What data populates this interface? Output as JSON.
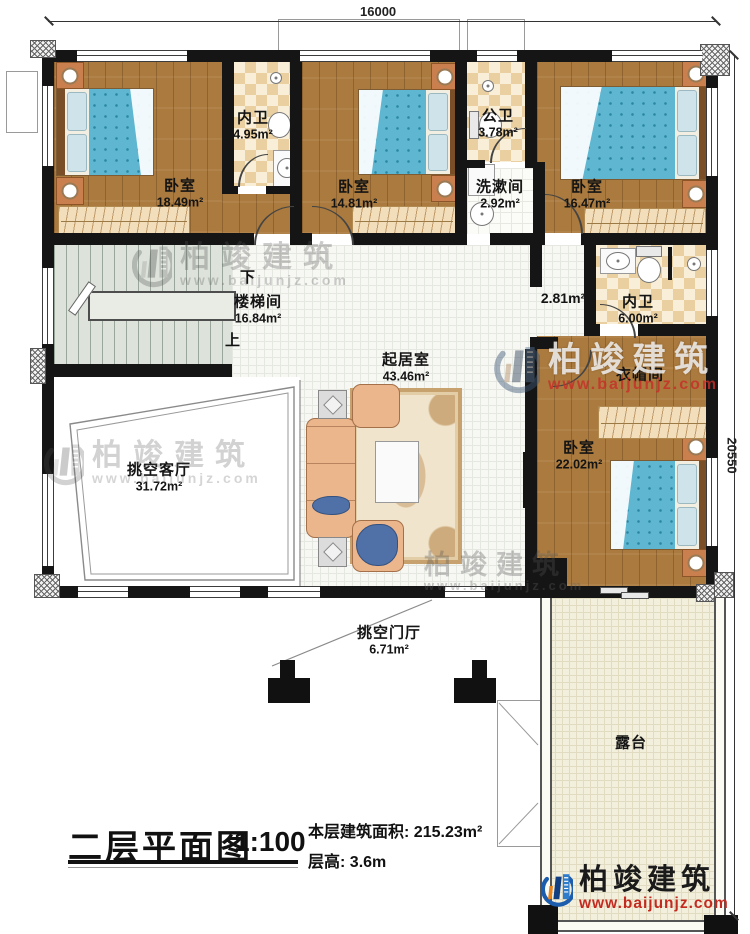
{
  "dimensions": {
    "top": "16000",
    "right": "20550"
  },
  "rooms": {
    "bedroom_tl": {
      "name": "卧室",
      "area": "18.49m²"
    },
    "bath_tl": {
      "name": "内卫",
      "area": "4.95m²"
    },
    "bedroom_tm": {
      "name": "卧室",
      "area": "14.81m²"
    },
    "bath_public": {
      "name": "公卫",
      "area": "3.78m²"
    },
    "washroom": {
      "name": "洗漱间",
      "area": "2.92m²"
    },
    "bedroom_tr": {
      "name": "卧室",
      "area": "16.47m²"
    },
    "stairwell": {
      "name": "楼梯间",
      "area": "16.84m²",
      "down": "下",
      "up": "上"
    },
    "living": {
      "name": "起居室",
      "area": "43.46m²"
    },
    "hallway": {
      "area": "2.81m²"
    },
    "bath_right": {
      "name": "内卫",
      "area": "6.00m²"
    },
    "cloakroom": {
      "name": "衣帽间"
    },
    "bedroom_br": {
      "name": "卧室",
      "area": "22.02m²"
    },
    "void_living": {
      "name": "挑空客厅",
      "area": "31.72m²"
    },
    "void_foyer": {
      "name": "挑空门厅",
      "area": "6.71m²"
    },
    "terrace": {
      "name": "露台"
    }
  },
  "title_block": {
    "plan_name": "二层平面图",
    "scale": "1:100",
    "area_label": "本层建筑面积:",
    "area_value": "215.23m²",
    "height_label": "层高:",
    "height_value": "3.6m"
  },
  "brand": {
    "name": "柏竣建筑",
    "website": "www.baijunjz.com",
    "brand_blue": "#1d5dad",
    "brand_red": "#c42b20"
  },
  "palette": {
    "wall": "#151515",
    "wood_floor": "#aa7a3e",
    "bath_tile": "#ead0a0",
    "bed_fabric": "#5fb6d0",
    "sofa_fabric": "#ecb68c",
    "terrace_floor": "#f3efdd"
  }
}
